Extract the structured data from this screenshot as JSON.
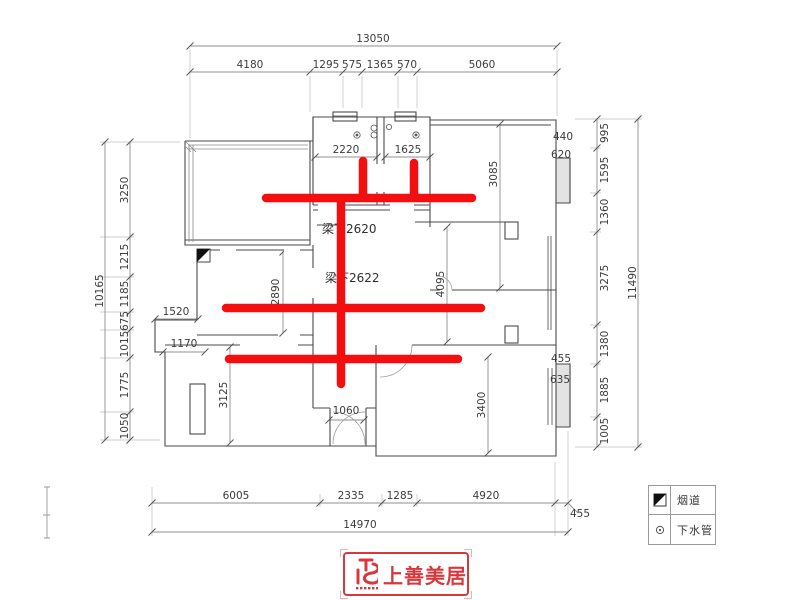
{
  "drawing": {
    "beam_label_1": "梁下2620",
    "beam_label_2": "梁下2622",
    "dims": {
      "top_total": "13050",
      "top": [
        "4180",
        "1295",
        "575",
        "1365",
        "570",
        "5060"
      ],
      "left_total": "10165",
      "left": [
        "3250",
        "1215",
        "1185",
        "675",
        "1015",
        "1775",
        "1050"
      ],
      "right_total": "11490",
      "right": [
        "995",
        "1595",
        "1360",
        "3275",
        "1380",
        "1885",
        "1005"
      ],
      "right_notch_top": [
        "440",
        "620"
      ],
      "right_notch_bottom": [
        "455",
        "635"
      ],
      "bottom_total": "14970",
      "bottom": [
        "6005",
        "2335",
        "1285",
        "4920",
        "455"
      ],
      "interior": {
        "bath_left": "2220",
        "bath_right": "1625",
        "room_top_right": "3085",
        "room_middle": "4095",
        "room_middle_left": "2890",
        "step_upper": "1520",
        "step_lower": "1170",
        "room_bottom_left": "3125",
        "entry_door": "1060",
        "room_bottom_right": "3400"
      }
    }
  },
  "legend": {
    "rows": [
      {
        "icon": "flue-icon",
        "label": "烟道"
      },
      {
        "icon": "drain-icon",
        "label": "下水管"
      }
    ]
  },
  "logo": {
    "brand": "上善美居"
  },
  "colors": {
    "overlay_red": "#f30f0f",
    "logo_red": "#d7383d",
    "wall": "#4a4a4a",
    "dim_line": "#8f8f8f"
  }
}
